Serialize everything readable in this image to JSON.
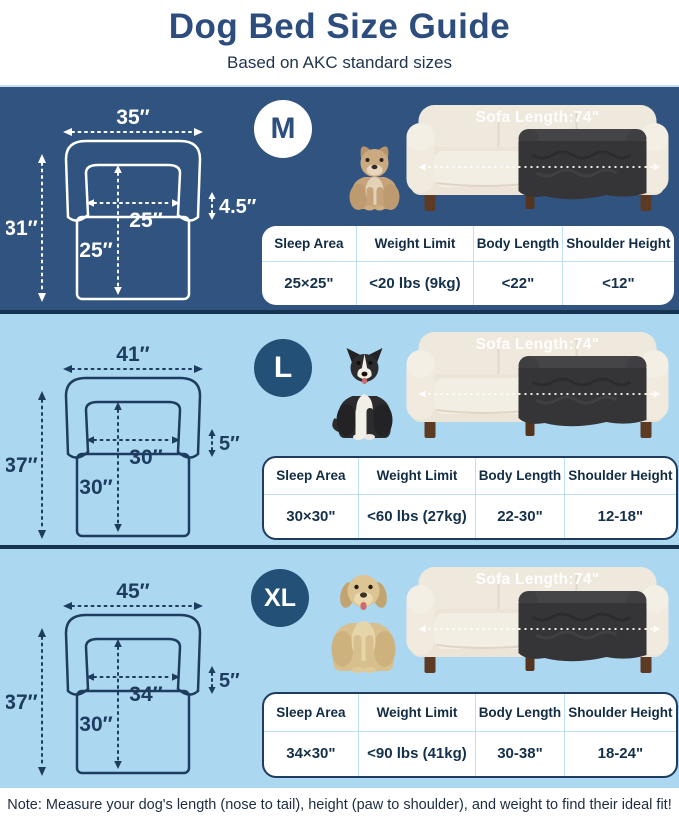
{
  "header": {
    "title": "Dog Bed Size Guide",
    "subtitle": "Based on AKC standard sizes"
  },
  "sofa_label": "Sofa Length:74\"",
  "table_headers": [
    "Sleep Area",
    "Weight Limit",
    "Body Length",
    "Shoulder Height"
  ],
  "sections": [
    {
      "badge": "M",
      "dog": "french-bulldog",
      "dimensions": {
        "width": "35″",
        "height": "31″",
        "inner_width": "25″",
        "inner_depth": "25″",
        "bolster": "4.5″"
      },
      "specs": {
        "sleep_area": "25×25\"",
        "weight_limit": "<20 lbs (9kg)",
        "body_length": "<22\"",
        "shoulder_height": "<12\""
      }
    },
    {
      "badge": "L",
      "dog": "border-collie",
      "dimensions": {
        "width": "41″",
        "height": "37″",
        "inner_width": "30″",
        "inner_depth": "30″",
        "bolster": "5″"
      },
      "specs": {
        "sleep_area": "30×30\"",
        "weight_limit": "<60 lbs (27kg)",
        "body_length": "22-30\"",
        "shoulder_height": "12-18\""
      }
    },
    {
      "badge": "XL",
      "dog": "labrador",
      "dimensions": {
        "width": "45″",
        "height": "37″",
        "inner_width": "34″",
        "inner_depth": "30″",
        "bolster": "5″"
      },
      "specs": {
        "sleep_area": "34×30\"",
        "weight_limit": "<90 lbs (41kg)",
        "body_length": "30-38\"",
        "shoulder_height": "18-24\""
      }
    }
  ],
  "footer": {
    "note": "Note: Measure your dog's length (nose to tail), height (paw to shoulder), and weight to find their ideal fit!"
  },
  "colors": {
    "title_blue": "#2c4d7d",
    "dark_section_bg": "#30547f",
    "light_section_bg": "#abd7f0",
    "divider_navy": "#16334f",
    "diagram_line_light": "#ffffff",
    "diagram_line_dark": "#1e3c5f",
    "badge_dark": "#235077",
    "table_divider": "#bfe0f2",
    "sofa_cream": "#efe9dd",
    "cover_dark": "#353537",
    "leg_brown": "#5d3a24"
  }
}
